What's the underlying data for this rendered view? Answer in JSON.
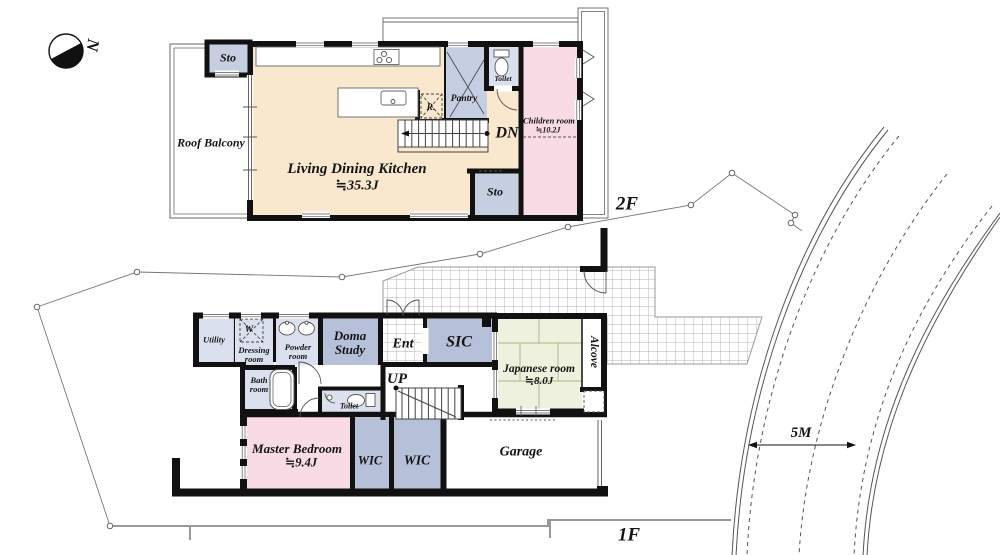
{
  "site": {
    "compass_label": "N",
    "road_width_label": "5M",
    "floor2_label": "2F",
    "floor1_label": "1F"
  },
  "floor2": {
    "sto_top": "Sto",
    "roof_balcony": "Roof Balcony",
    "ldk": {
      "name": "Living Dining Kitchen",
      "size": "≒35.3J"
    },
    "pantry": "Pantry",
    "toilet": "Toilet",
    "refrigerator": "R.",
    "stairs_down": "DN",
    "children_room": {
      "name": "Children room",
      "size": "≒10.2J"
    },
    "sto_bottom": "Sto"
  },
  "floor1": {
    "utility": "Utility",
    "washer": "W",
    "dressing_room": "Dressing room",
    "powder_room": "Powder room",
    "doma_study": "Doma Study",
    "entrance": "Ent",
    "sic": "SIC",
    "japanese_room": {
      "name": "Japanese room",
      "size": "≒8.0J"
    },
    "alcove": "Alcove",
    "bath_room": "Bath room",
    "toilet": "Toilet",
    "stairs_up": "UP",
    "master_bedroom": {
      "name": "Master Bedroom",
      "size": "≒9.4J"
    },
    "wic_left": "WIC",
    "wic_right": "WIC",
    "garage": "Garage"
  },
  "colors": {
    "wall": "#111111",
    "ldk_cream": "#FAE8CE",
    "bedroom_pink": "#F8DBE4",
    "room_light": "#DAE0EE",
    "room_mid": "#C6CEE2",
    "room_dark": "#B6C0D8",
    "tatami_green": "#EDF1DD",
    "tile_line": "#9a9a9a"
  }
}
